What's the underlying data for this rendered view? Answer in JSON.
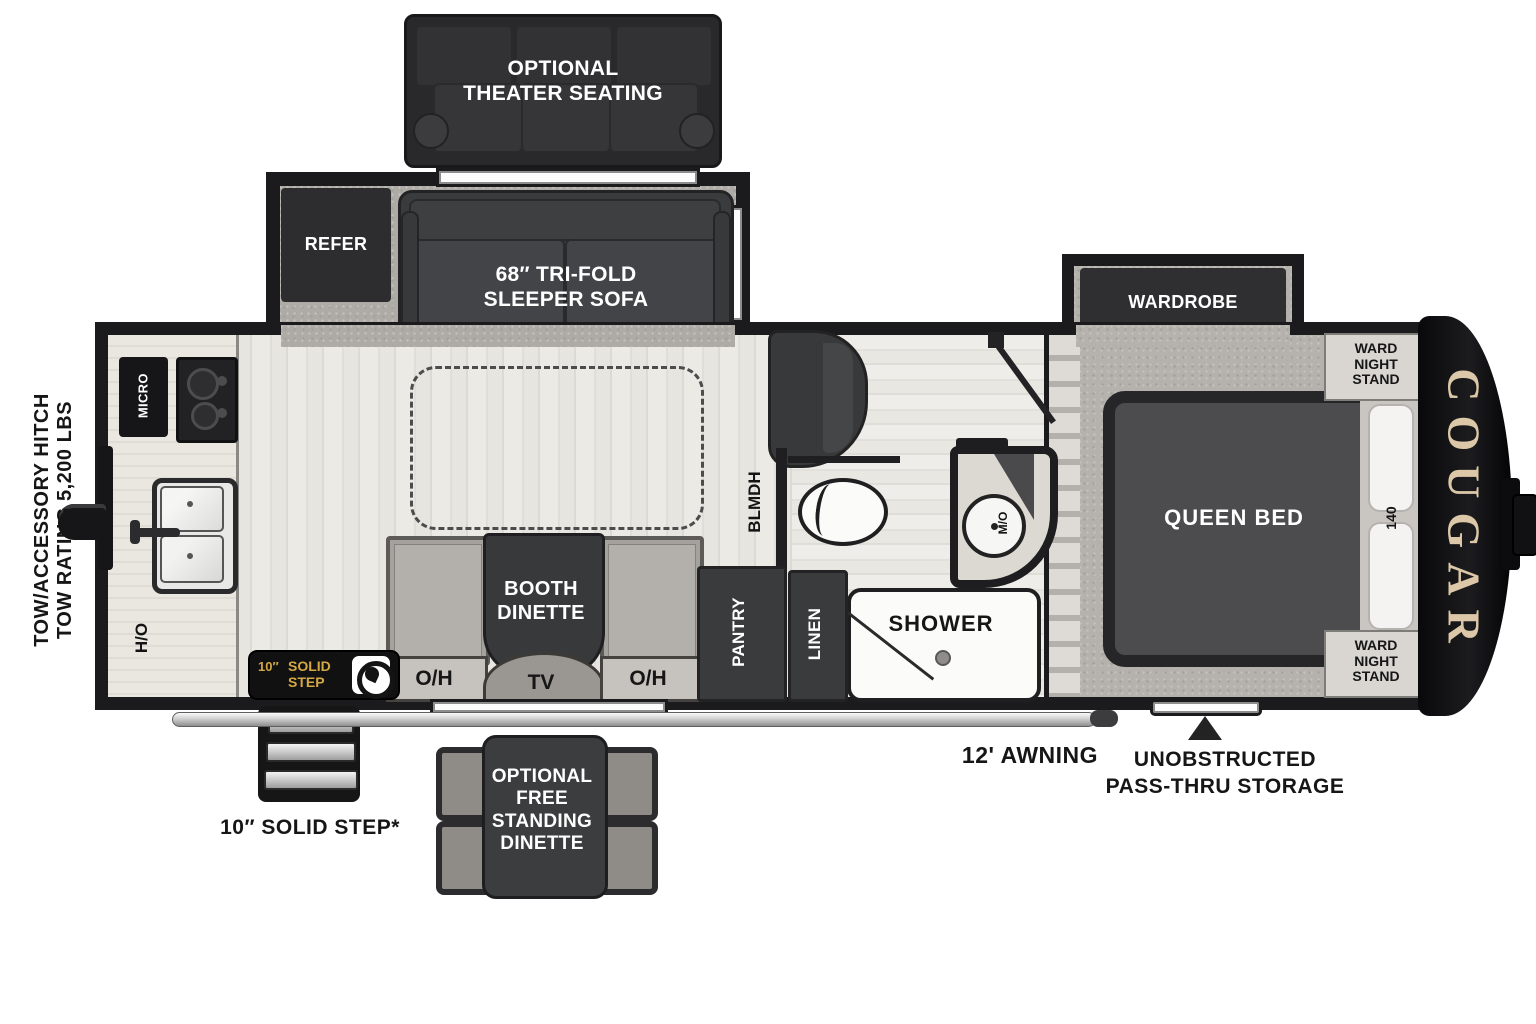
{
  "exterior": {
    "hitch_line1": "TOW/ACCESSORY HITCH",
    "hitch_line2": "TOW RATING 5,200 LBS",
    "awning_label": "12' AWNING",
    "passthru_line1": "UNOBSTRUCTED",
    "passthru_line2": "PASS-THRU STORAGE",
    "solid_step_caption": "10″ SOLID STEP*",
    "step_badge_size": "10″",
    "step_badge_text": "SOLID STEP",
    "brand": "COUGAR"
  },
  "options": {
    "theater_line1": "OPTIONAL",
    "theater_line2": "THEATER SEATING",
    "dinette_line1": "OPTIONAL",
    "dinette_line2": "FREE",
    "dinette_line3": "STANDING",
    "dinette_line4": "DINETTE"
  },
  "living": {
    "refer": "REFER",
    "sofa_line1": "68″ TRI-FOLD",
    "sofa_line2": "SLEEPER SOFA",
    "booth_line1": "BOOTH",
    "booth_line2": "DINETTE",
    "oh_left": "O/H",
    "oh_right": "O/H",
    "tv": "TV",
    "chair_note": "BLMDH"
  },
  "kitchen": {
    "micro": "MICRO",
    "ho": "H/O"
  },
  "bath": {
    "pantry": "PANTRY",
    "linen": "LINEN",
    "shower": "SHOWER",
    "sink": "M/O"
  },
  "bedroom": {
    "wardrobe": "WARDROBE",
    "stand_line1": "WARD",
    "stand_line2": "NIGHT",
    "stand_line3": "STAND",
    "queen_bed": "QUEEN BED",
    "bed_dim": "140"
  }
}
